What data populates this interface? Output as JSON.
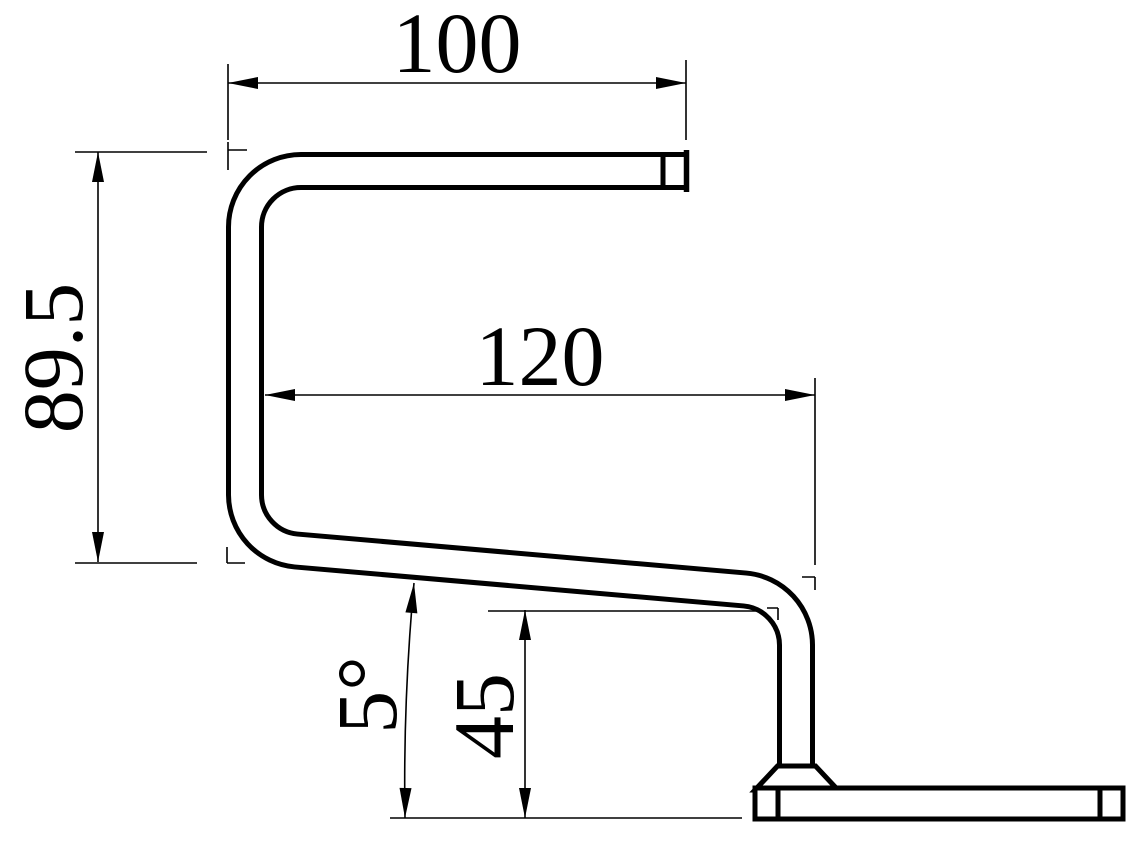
{
  "drawing": {
    "background": "#ffffff",
    "line_color": "#000000",
    "dimensions": {
      "top_width": "100",
      "left_height": "89.5",
      "mid_width": "120",
      "angle": "5°",
      "right_height": "45"
    }
  }
}
